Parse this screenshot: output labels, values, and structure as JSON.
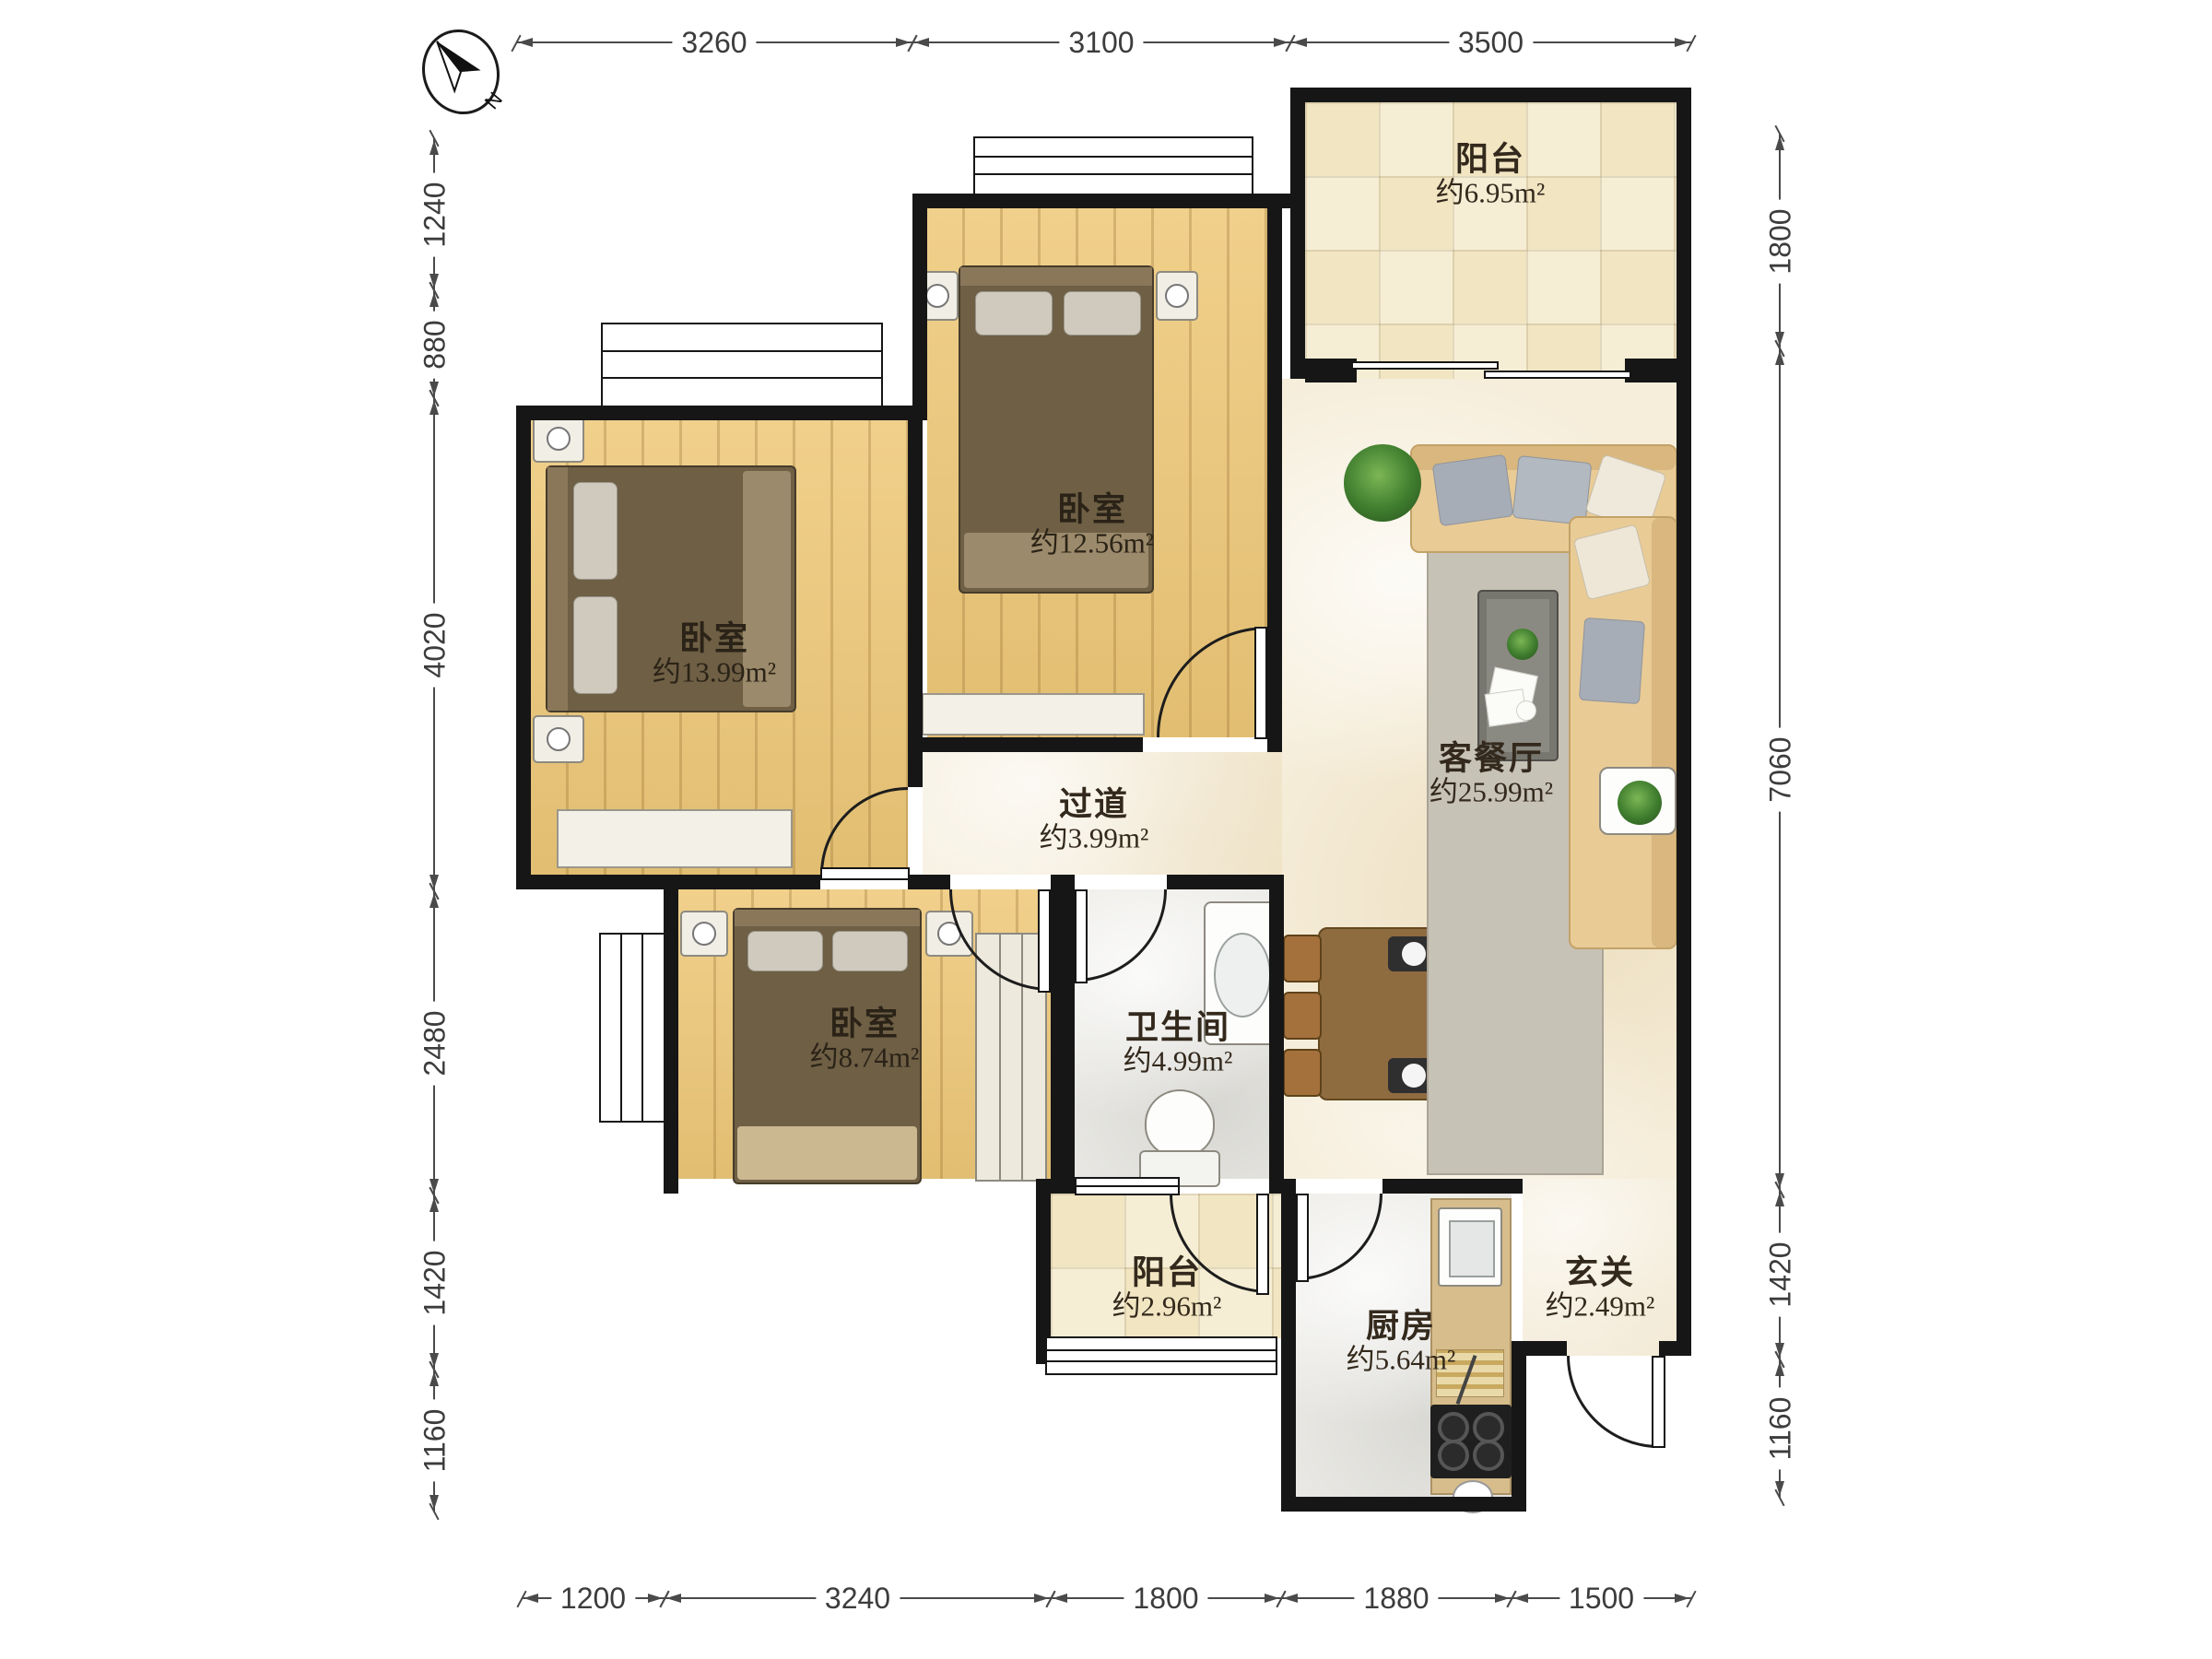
{
  "compass": {
    "label": "N"
  },
  "dimensions": {
    "top": [
      "3260",
      "3100",
      "3500"
    ],
    "bottom": [
      "1200",
      "3240",
      "1800",
      "1880",
      "1500"
    ],
    "left": [
      "1240",
      "880",
      "4020",
      "2480",
      "1420",
      "1160"
    ],
    "right": [
      "1800",
      "7060",
      "1420",
      "1160"
    ]
  },
  "rooms": {
    "balcony_top": {
      "name": "阳台",
      "area": "约6.95m²"
    },
    "bedroom_mid": {
      "name": "卧室",
      "area": "约12.56m²"
    },
    "bedroom_left": {
      "name": "卧室",
      "area": "约13.99m²"
    },
    "living": {
      "name": "客餐厅",
      "area": "约25.99m²"
    },
    "hallway": {
      "name": "过道",
      "area": "约3.99m²"
    },
    "bedroom_lower": {
      "name": "卧室",
      "area": "约8.74m²"
    },
    "bathroom": {
      "name": "卫生间",
      "area": "约4.99m²"
    },
    "balcony_bottom": {
      "name": "阳台",
      "area": "约2.96m²"
    },
    "kitchen": {
      "name": "厨房",
      "area": "约5.64m²"
    },
    "entry": {
      "name": "玄关",
      "area": "约2.49m²"
    }
  },
  "colors": {
    "wall": "#161616",
    "wood_floor": "#eec878",
    "marble_floor": "#f6eedb",
    "tile_floor": "#f1e5c2",
    "gray_floor": "#ecebe7",
    "sofa": "#e9cb96",
    "dining_table": "#8f6b40"
  }
}
